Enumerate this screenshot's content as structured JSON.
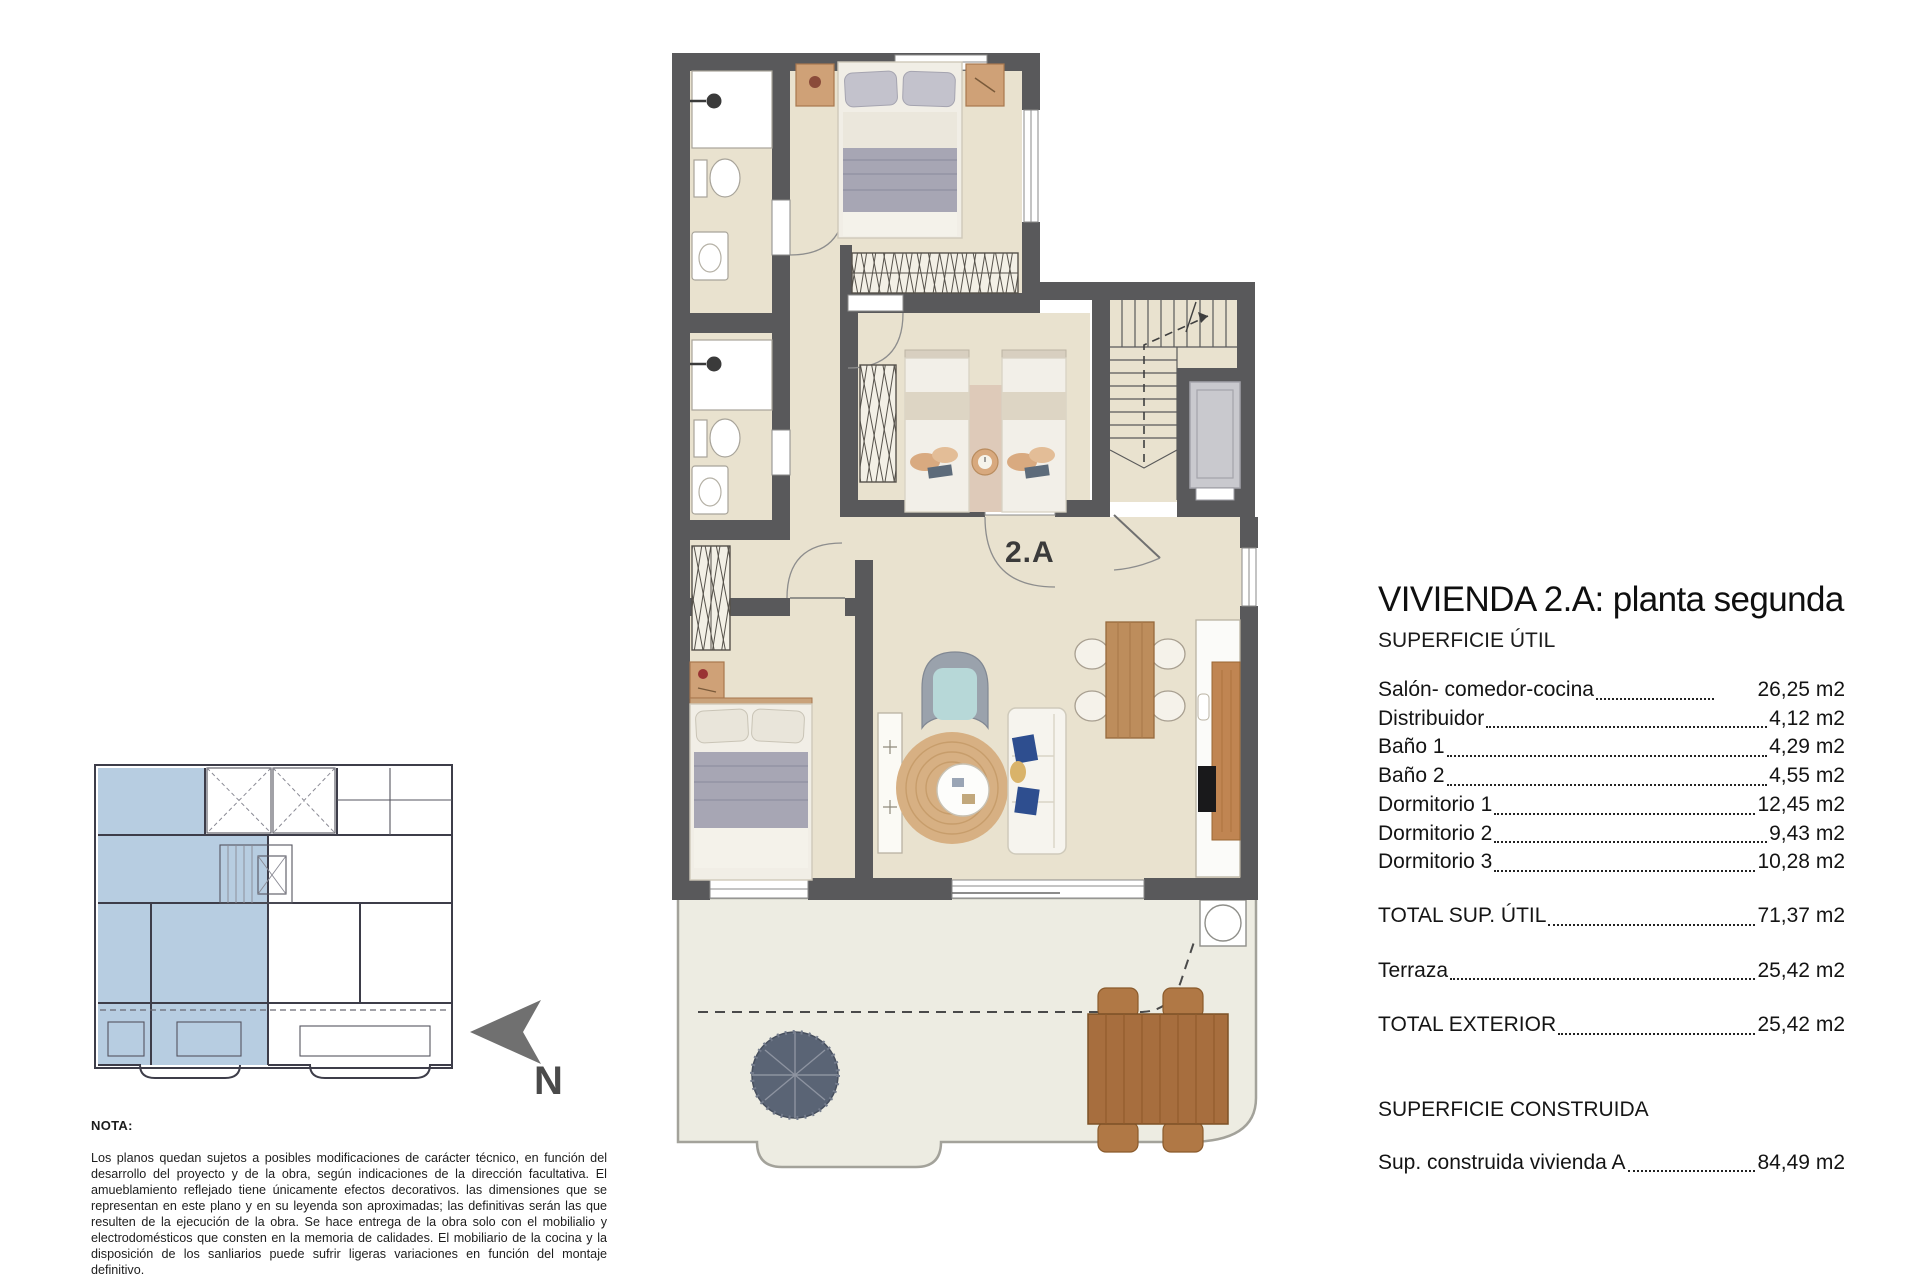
{
  "plan": {
    "unit_label": "2.A",
    "north_label": "N",
    "colors": {
      "wall": "#59595b",
      "floor": "#e9e2cf",
      "terrace": "#edece2",
      "keyplan_highlight": "#b7cde1",
      "wood": "#c08552",
      "accent_blue_pillow": "#2e4e8f"
    }
  },
  "panel": {
    "title": "VIVIENDA 2.A: planta segunda",
    "subtitle": "SUPERFICIE ÚTIL",
    "rooms": [
      {
        "label": "Salón- comedor-cocina",
        "value": "26,25 m2",
        "leader": "short"
      },
      {
        "label": "Distribuidor",
        "value": "4,12 m2"
      },
      {
        "label": "Baño 1",
        "value": "4,29 m2"
      },
      {
        "label": "Baño 2",
        "value": "4,55 m2"
      },
      {
        "label": "Dormitorio 1",
        "value": "12,45 m2"
      },
      {
        "label": "Dormitorio 2",
        "value": "9,43 m2"
      },
      {
        "label": "Dormitorio 3",
        "value": "10,28 m2"
      }
    ],
    "totals": [
      {
        "label": "TOTAL SUP. ÚTIL",
        "value": "71,37 m2"
      },
      {
        "label": "Terraza",
        "value": "25,42 m2"
      },
      {
        "label": "TOTAL EXTERIOR",
        "value": "25,42 m2"
      }
    ],
    "built_heading": "SUPERFICIE CONSTRUIDA",
    "built": [
      {
        "label": "Sup. construida vivienda A",
        "value": "84,49 m2"
      }
    ]
  },
  "nota": {
    "heading": "NOTA:",
    "body": "Los planos quedan sujetos a posibles modificaciones de carácter técnico, en función del desarrollo del proyecto y de la obra, según indicaciones de la dirección facultativa. El amueblamiento reflejado tiene únicamente efectos decorativos. las dimensiones que se representan en este plano y en su leyenda son aproximadas; las definitivas serán las que resulten de la ejecución de la obra. Se hace entrega de la obra solo con el mobilialio y electrodomésticos que consten en la memoria de calidades. El mobiliario de la cocina y la disposición de los sanliarios puede sufrir ligeras variaciones en función del montaje definitivo."
  }
}
